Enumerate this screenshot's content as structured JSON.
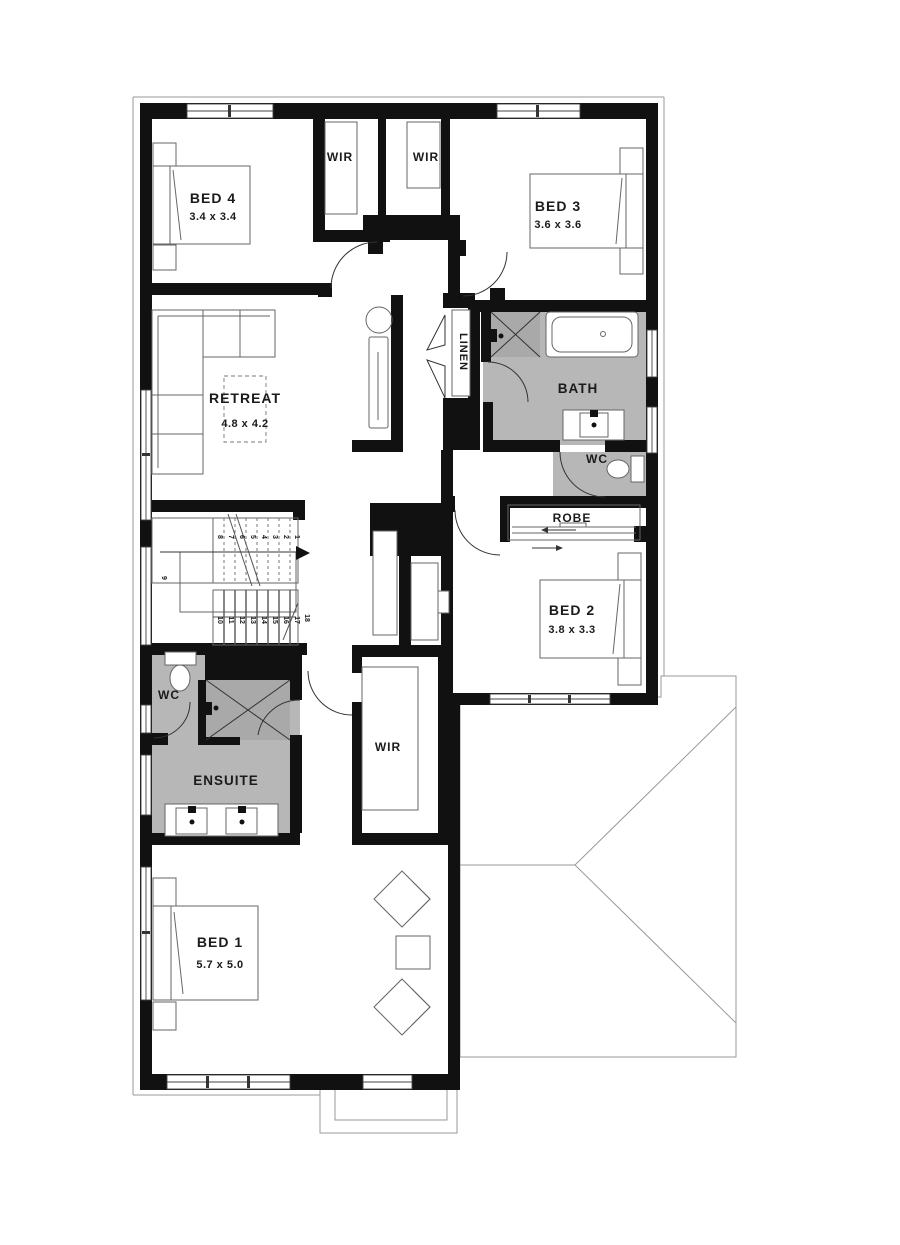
{
  "plan": {
    "rooms": {
      "bed4": {
        "label": "BED 4",
        "dims": "3.4 x 3.4"
      },
      "bed3": {
        "label": "BED 3",
        "dims": "3.6 x 3.6"
      },
      "bed2": {
        "label": "BED 2",
        "dims": "3.8 x 3.3"
      },
      "bed1": {
        "label": "BED 1",
        "dims": "5.7 x 5.0"
      },
      "retreat": {
        "label": "RETREAT",
        "dims": "4.8 x 4.2"
      },
      "ensuite": {
        "label": "ENSUITE"
      },
      "bath": {
        "label": "BATH"
      },
      "wir_top_left": {
        "label": "WIR"
      },
      "wir_top_right": {
        "label": "WIR"
      },
      "wir_master": {
        "label": "WIR"
      },
      "robe": {
        "label": "ROBE"
      },
      "linen": {
        "label": "LINEN"
      },
      "wc_bath": {
        "label": "WC"
      },
      "wc_ensuite": {
        "label": "WC"
      }
    },
    "stairs": {
      "upper_treads": [
        "8",
        "7",
        "6",
        "5",
        "4",
        "3",
        "2",
        "1"
      ],
      "landing": "9",
      "lower_treads": [
        "10",
        "11",
        "12",
        "13",
        "14",
        "15",
        "16",
        "17"
      ],
      "last": "18"
    },
    "colors": {
      "wall": "#111111",
      "wet_floor": "#b7b7b7",
      "shower_floor": "#a9a9a9",
      "roof_line": "#9a9a9a"
    }
  }
}
